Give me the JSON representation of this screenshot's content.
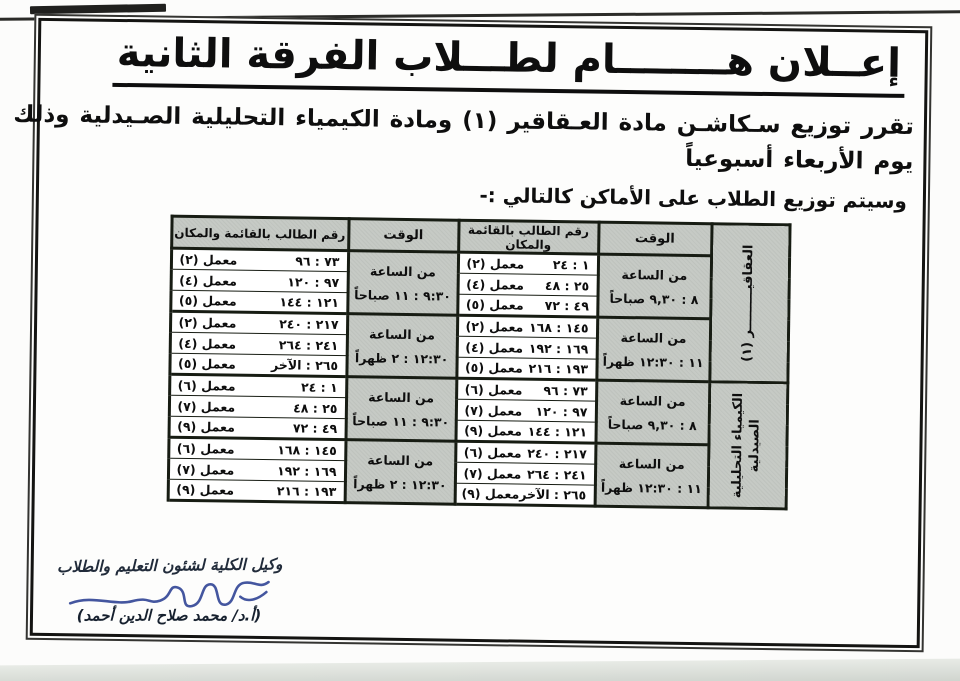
{
  "announcement": {
    "title": "إعــلان هــــــــام لطـــلاب الفرقة الثانية",
    "body_line1": "تقرر توزيع سـكاشـن مادة العـقاقير (١) ومادة الكيمياء التحليلية الصـيدلية وذلك",
    "body_line2": "يوم الأربعاء أسبوعياً",
    "subtitle": "وسيتم توزيع الطلاب على الأماكن كالتالي :-"
  },
  "table": {
    "headers": {
      "time": "الوقت",
      "students": "رقم الطالب بالقائمة والمكان"
    },
    "subjects": [
      {
        "line1": "العقاقيـــــــــر (١)",
        "line2": ""
      },
      {
        "line1": "الكيمياء التحليلية",
        "line2": "الصيدلية"
      }
    ],
    "groups": [
      {
        "right_time": [
          "من الساعة",
          "٨ : ٩,٣٠ صباحاً"
        ],
        "left_time": [
          "من الساعة",
          "٩:٣٠ : ١١ صباحاً"
        ],
        "rows": [
          {
            "right": {
              "range": "١ : ٢٤",
              "room": "معمل (٢)"
            },
            "left": {
              "range": "٧٣ : ٩٦",
              "room": "معمل (٢)"
            }
          },
          {
            "right": {
              "range": "٢٥ : ٤٨",
              "room": "معمل (٤)"
            },
            "left": {
              "range": "٩٧ : ١٢٠",
              "room": "معمل (٤)"
            }
          },
          {
            "right": {
              "range": "٤٩ : ٧٢",
              "room": "معمل (٥)"
            },
            "left": {
              "range": "١٢١ : ١٤٤",
              "room": "معمل (٥)"
            }
          }
        ]
      },
      {
        "right_time": [
          "من الساعة",
          "١١ : ١٢:٣٠ ظهراً"
        ],
        "left_time": [
          "من الساعة",
          "١٢:٣٠ : ٢ ظهراً"
        ],
        "rows": [
          {
            "right": {
              "range": "١٤٥ : ١٦٨",
              "room": "معمل (٢)"
            },
            "left": {
              "range": "٢١٧ : ٢٤٠",
              "room": "معمل (٢)"
            }
          },
          {
            "right": {
              "range": "١٦٩ : ١٩٢",
              "room": "معمل (٤)"
            },
            "left": {
              "range": "٢٤١ : ٢٦٤",
              "room": "معمل (٤)"
            }
          },
          {
            "right": {
              "range": "١٩٣ : ٢١٦",
              "room": "معمل (٥)"
            },
            "left": {
              "range": "٢٦٥ : الآخر",
              "room": "معمل (٥)"
            }
          }
        ]
      },
      {
        "right_time": [
          "من الساعة",
          "٨ : ٩,٣٠ صباحاً"
        ],
        "left_time": [
          "من الساعة",
          "٩:٣٠ : ١١ صباحاً"
        ],
        "rows": [
          {
            "right": {
              "range": "٧٣ : ٩٦",
              "room": "معمل (٦)"
            },
            "left": {
              "range": "١ : ٢٤",
              "room": "معمل (٦)"
            }
          },
          {
            "right": {
              "range": "٩٧ : ١٢٠",
              "room": "معمل (٧)"
            },
            "left": {
              "range": "٢٥ : ٤٨",
              "room": "معمل (٧)"
            }
          },
          {
            "right": {
              "range": "١٢١ : ١٤٤",
              "room": "معمل (٩)"
            },
            "left": {
              "range": "٤٩ : ٧٢",
              "room": "معمل (٩)"
            }
          }
        ]
      },
      {
        "right_time": [
          "من الساعة",
          "١١ : ١٢:٣٠ ظهراً"
        ],
        "left_time": [
          "من الساعة",
          "١٢:٣٠ : ٢ ظهراً"
        ],
        "rows": [
          {
            "right": {
              "range": "٢١٧ : ٢٤٠",
              "room": "معمل (٦)"
            },
            "left": {
              "range": "١٤٥ : ١٦٨",
              "room": "معمل (٦)"
            }
          },
          {
            "right": {
              "range": "٢٤١ : ٢٦٤",
              "room": "معمل (٧)"
            },
            "left": {
              "range": "١٦٩ : ١٩٢",
              "room": "معمل (٧)"
            }
          },
          {
            "right": {
              "range": "٢٦٥ : الآخر",
              "room": "معمل (٩)"
            },
            "left": {
              "range": "١٩٣ : ٢١٦",
              "room": "معمل (٩)"
            }
          }
        ]
      }
    ]
  },
  "signature": {
    "role": "وكيل الكلية لشئون التعليم والطلاب",
    "name": "(أ.د/ محمد صلاح الدين أحمد)"
  },
  "colors": {
    "table_border": "#171c13",
    "cell_gray": "#c6cac5",
    "ink": "#0e0e0e",
    "signature_blue": "#44569f"
  }
}
